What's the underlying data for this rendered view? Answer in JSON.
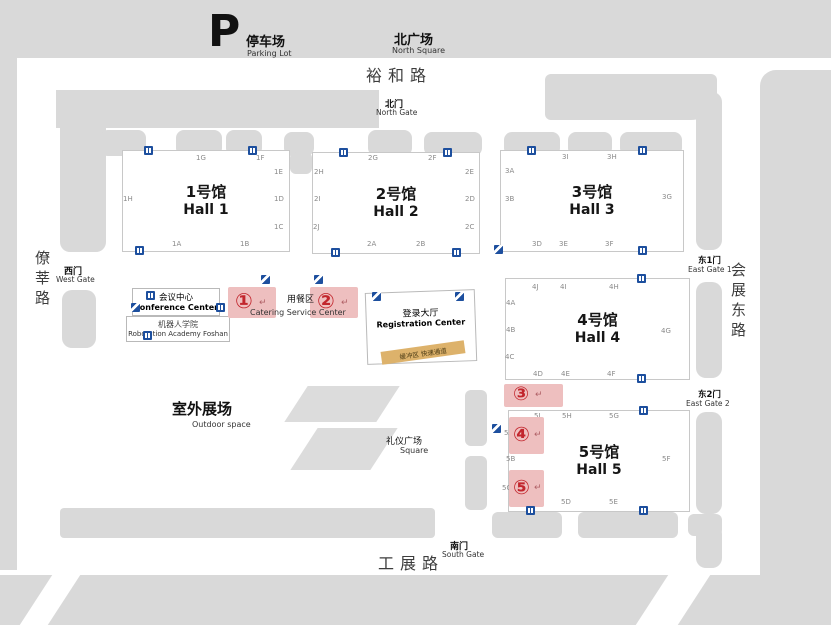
{
  "map": {
    "parking": {
      "symbol": "P",
      "cn": "停车场",
      "en": "Parking Lot"
    },
    "north_square": {
      "cn": "北广场",
      "en": "North Square"
    },
    "roads": {
      "north": "裕和路",
      "west": "僚莘路",
      "east": "会展东路",
      "south": "工展路"
    },
    "gates": {
      "north": {
        "cn": "北门",
        "en": "North Gate"
      },
      "west": {
        "cn": "西门",
        "en": "West Gate"
      },
      "east1": {
        "cn": "东1门",
        "en": "East Gate 1"
      },
      "east2": {
        "cn": "东2门",
        "en": "East Gate 2"
      },
      "south": {
        "cn": "南门",
        "en": "South Gate"
      }
    },
    "halls": [
      {
        "cn": "1号馆",
        "en": "Hall 1",
        "gates": [
          "1A",
          "1B",
          "1C",
          "1D",
          "1E",
          "1F",
          "1G",
          "1H"
        ]
      },
      {
        "cn": "2号馆",
        "en": "Hall 2",
        "gates": [
          "2A",
          "2B",
          "2C",
          "2D",
          "2E",
          "2F",
          "2G",
          "2H",
          "2I",
          "2J"
        ]
      },
      {
        "cn": "3号馆",
        "en": "Hall 3",
        "gates": [
          "3A",
          "3B",
          "3D",
          "3E",
          "3F",
          "3G",
          "3H",
          "3I"
        ]
      },
      {
        "cn": "4号馆",
        "en": "Hall 4",
        "gates": [
          "4A",
          "4B",
          "4C",
          "4D",
          "4E",
          "4F",
          "4G",
          "4H",
          "4I",
          "4J"
        ]
      },
      {
        "cn": "5号馆",
        "en": "Hall 5",
        "gates": [
          "5A",
          "5B",
          "5C",
          "5D",
          "5E",
          "5F",
          "5G",
          "5H",
          "5I"
        ]
      }
    ],
    "facilities": {
      "conference": {
        "cn": "会议中心",
        "en": "Conference Center"
      },
      "academy": {
        "cn": "机器人学院",
        "en": "Robotation Academy Foshan"
      },
      "catering": {
        "cn": "用餐区",
        "en": "Catering Service Center"
      },
      "registration": {
        "cn": "登录大厅",
        "en": "Registration Center"
      },
      "buffer_strip": {
        "cn": "缓冲区  快速通道"
      },
      "outdoor": {
        "cn": "室外展场",
        "en": "Outdoor space"
      },
      "square": {
        "cn": "礼仪广场",
        "en": "Square"
      }
    },
    "markers": {
      "arrow": "↵",
      "items": [
        "①",
        "②",
        "③",
        "④",
        "⑤"
      ]
    },
    "icons": {
      "wc": "restroom-icon",
      "esc": "escalator-icon"
    },
    "colors": {
      "shape_gray": "#d9d9d9",
      "hall_border": "#c8c8c8",
      "icon_blue": "#1d4f9e",
      "marker_red": "#c2262d",
      "marker_pink": "#eebfbf",
      "strip_yellow": "#ddb26b"
    }
  }
}
